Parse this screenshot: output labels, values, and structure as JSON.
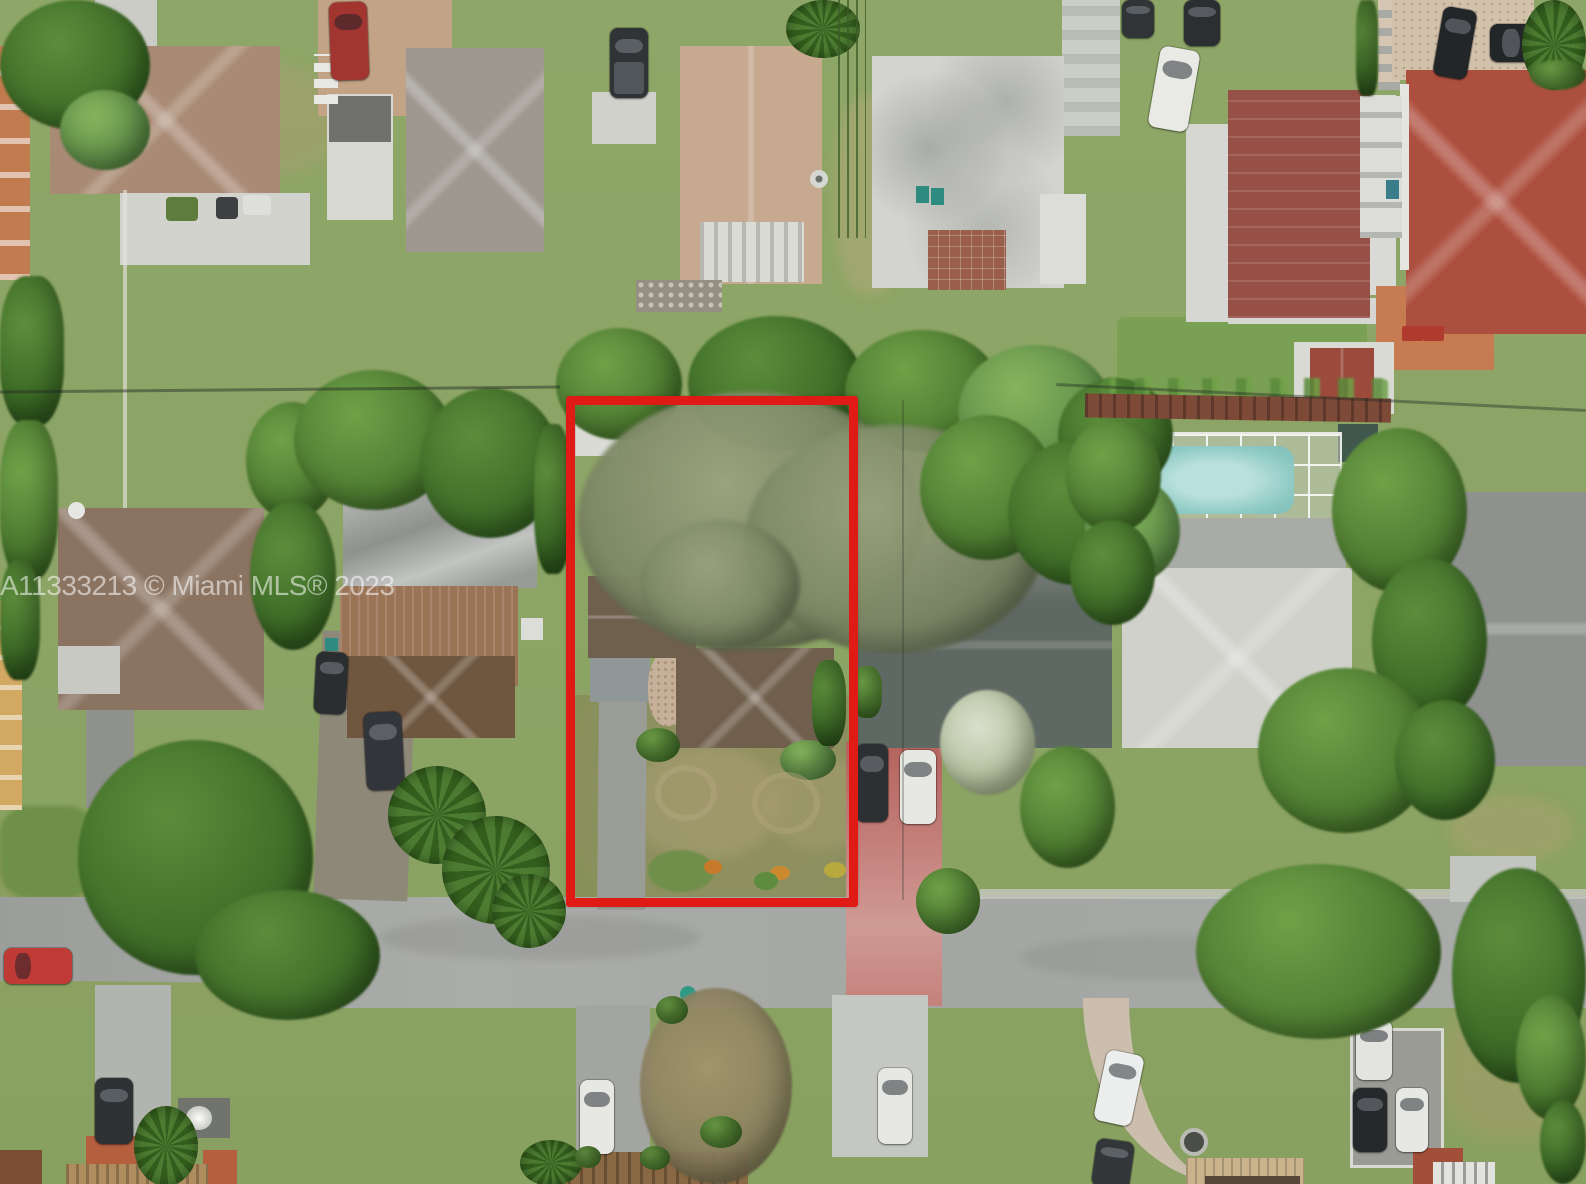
{
  "image": {
    "kind": "aerial-drone-real-estate-photo",
    "view": "top-down",
    "scene": "Suburban residential block with a single-family subject property outlined in red",
    "width_px": 1586,
    "height_px": 1184
  },
  "watermark": {
    "text": "A11333213 © Miami MLS® 2023",
    "color": "#ffffff",
    "opacity": 0.55
  },
  "subject_property": {
    "annotation": "red rectangular boundary outline",
    "contents": [
      "brown-shingle single-family house",
      "large overhanging tree canopy",
      "gray carport and straight concrete driveway",
      "small white storage shed",
      "patchy brown-green lawn",
      "flower bed near the street"
    ]
  },
  "features": [
    "asphalt street running horizontally near the bottom",
    "screened swimming pool at a neighboring house",
    "pink driveway with parked minivan and white car",
    "multiple parked cars on driveways, pads and street",
    "beige, red, maroon, white, gray and brown rooftops",
    "dense green tree canopies and palm trees",
    "overhead power line crossing the block"
  ],
  "colors": {
    "lot-outline": "#e01b15",
    "watermark-color": "#ffffff",
    "street-asphalt": "#a6a8a5",
    "concrete": "#c6c8c3",
    "pink-driveway": "#c5817c",
    "pool-water": "#8fcac5",
    "grass": "#8ca465",
    "canopy-green": "#4e7d31",
    "subject-roof-brown": "#6f5f4c",
    "red-tile-roof": "#ad4f3e",
    "white-roof": "#cfd1ca"
  }
}
